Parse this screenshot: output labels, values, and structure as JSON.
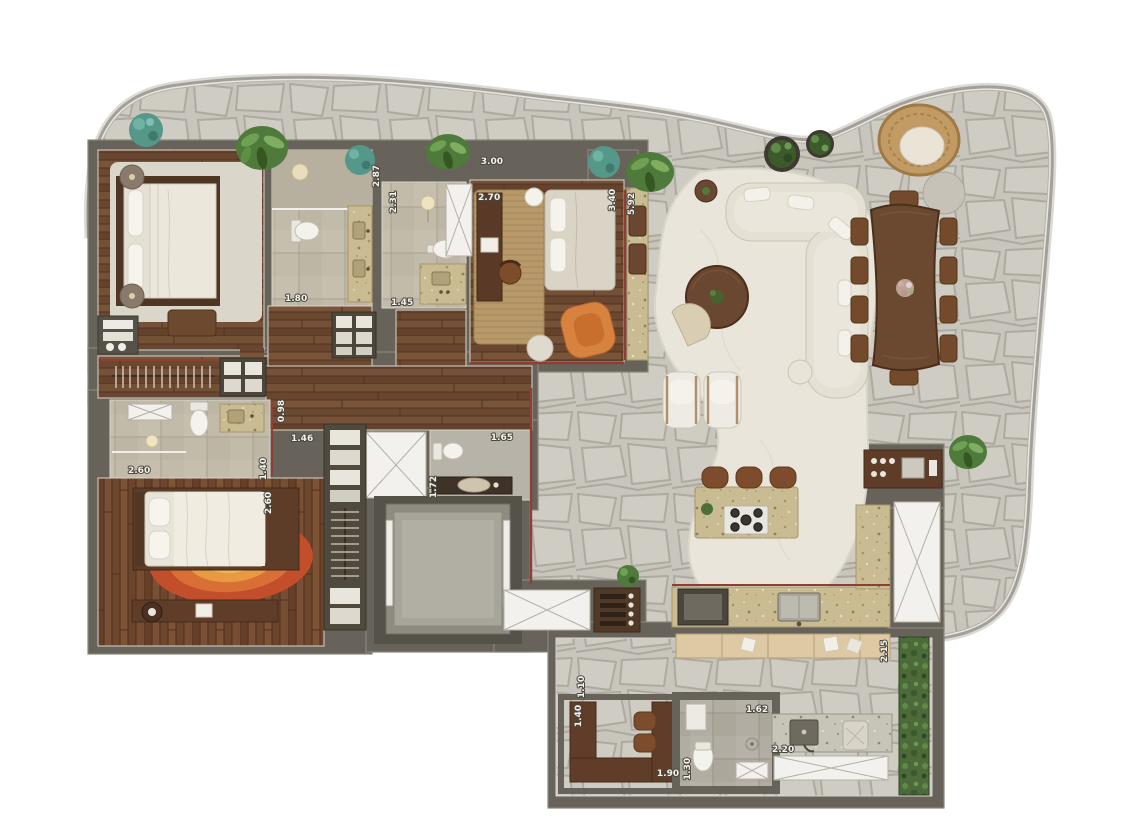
{
  "scene": {
    "kind": "3d-rendered-residential-floor-plan",
    "background": "#ffffff"
  },
  "palette": {
    "terrace_stone": "#c8c5bd",
    "stone_grout": "#a9a59b",
    "wall": "#67635a",
    "wall_edge": "#8a867b",
    "wood_floor": "#6f4c33",
    "wood_dark": "#5a3b26",
    "bath_tile": "#c2bbaa",
    "gray_tile": "#b1ada2",
    "counter_stone": "#c9bc92",
    "furniture_wood": "#5e3c27",
    "cream_fabric": "#e6e2d6",
    "orange_chair": "#d8823f",
    "rug_red": "#c24e2c",
    "rug_orange": "#dd8038",
    "plant_green": "#4e7a3c",
    "plant_teal": "#55988a",
    "accent_red_line": "#8e3f35",
    "white_panel": "#f2f1ed",
    "green_wall": "#4c6a3a",
    "rattan": "#c29a63"
  },
  "dimension_labels": {
    "master_bedroom_width": "3.00",
    "master_bath_depth": "2.87",
    "master_bath_width": "1.80",
    "bath2_depth": "2.31",
    "bath2_width": "1.45",
    "den_width": "2.70",
    "den_depth": "3.40",
    "living_terrace_depth": "5.92",
    "suite2_bath_width": "2.60",
    "suite2_bath_depth": "1.40",
    "hall_niche_depth": "0.98",
    "hall_width": "1.46",
    "suite2_depth": "2.60",
    "powder_room_width": "1.65",
    "powder_room_depth": "1.72",
    "service_hall_width": "1.10",
    "office_nook_depth": "1.40",
    "office_nook_width": "1.90",
    "service_bath_depth": "1.30",
    "service_bath_width": "1.62",
    "laundry_counter_width": "2.20",
    "green_wall_length": "2.15"
  }
}
